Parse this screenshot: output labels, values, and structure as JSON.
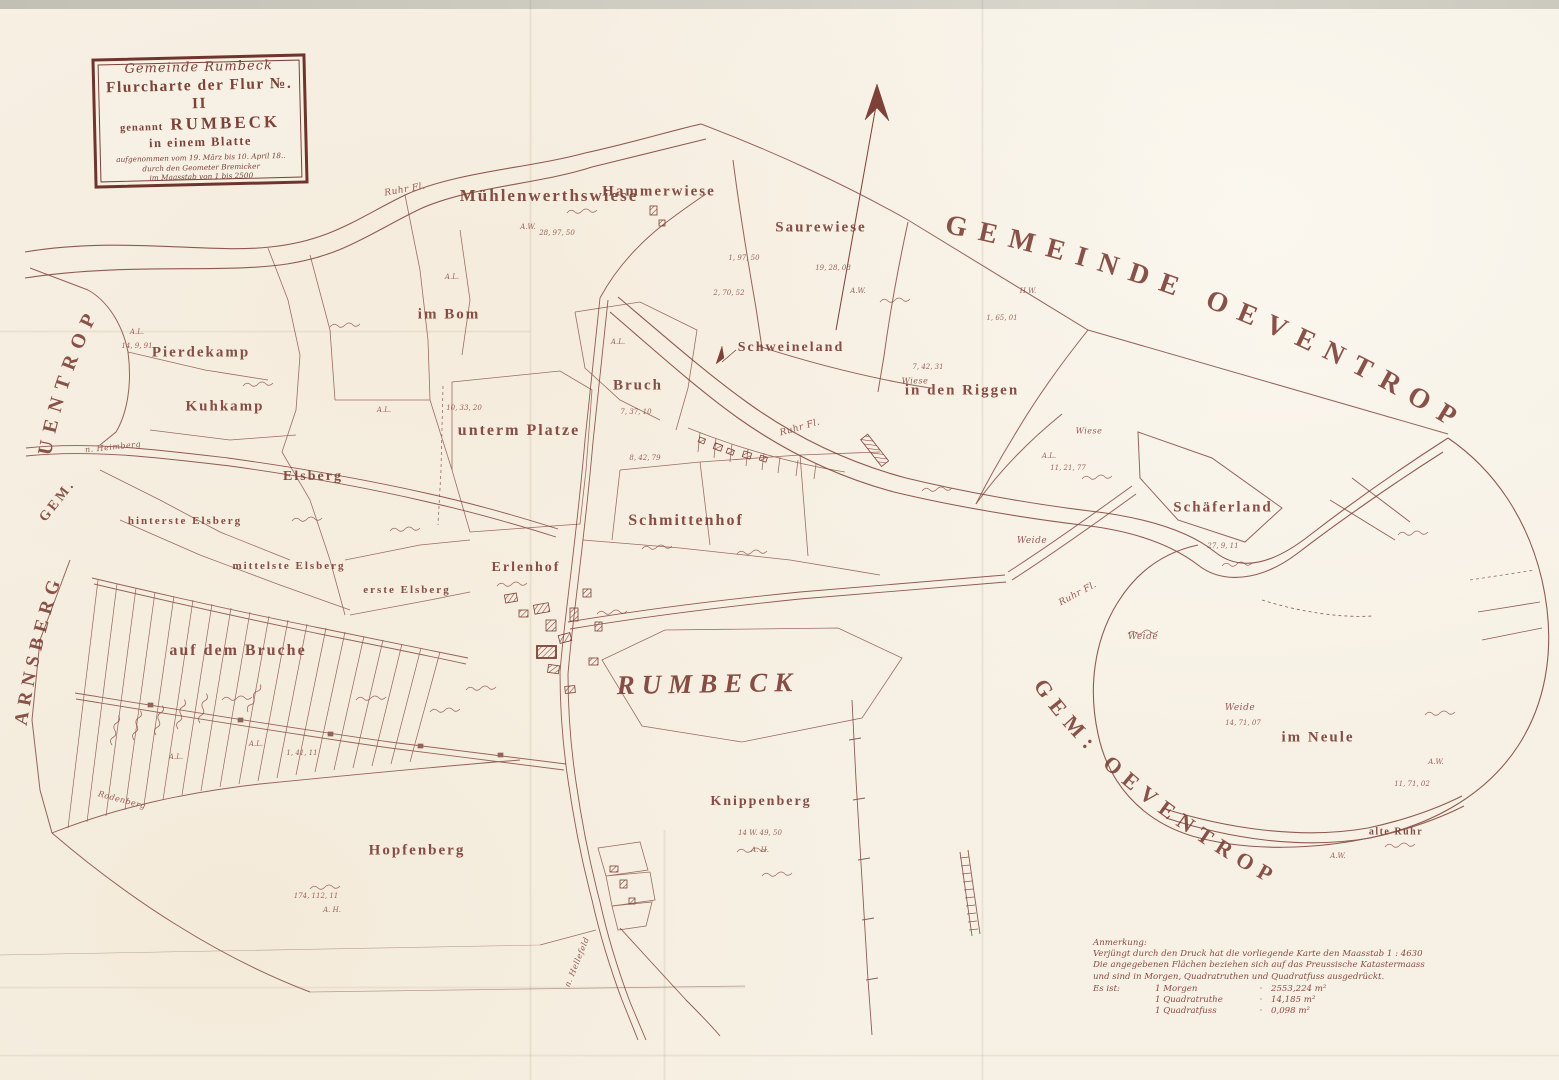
{
  "palette": {
    "paper": "#f6f0e4",
    "ink": "#7d4138",
    "ink_soft": "#8a4a40",
    "scan_edge": "#c9c7bc"
  },
  "cartouche": {
    "community": "Gemeinde Rumbeck",
    "title": "Flurcharte der Flur №. II",
    "called": "genannt",
    "name": "RUMBECK",
    "sheet": "in einem Blatte",
    "fine1": "aufgenommen vom 19. März bis 10. April 18..",
    "fine2": "durch den Geometer Bremicker",
    "fine3": "im Maasstab von 1 bis 2500"
  },
  "boundary_labels": {
    "gemeinde_oeventrop": "GEMEINDE OEVENTROP",
    "gem_oeventrop": "GEM: OEVENTROP",
    "uentrop": "UENTROP",
    "gem": "GEM.",
    "arnsberg": "ARNSBERG"
  },
  "place_labels": {
    "muehlenwerthswiese": "Mühlenwerthswiese",
    "hammerwiese": "Hammerwiese",
    "saurewiese": "Saurewiese",
    "im_bom": "im Bom",
    "pierdekamp": "Pierdekamp",
    "kuhkamp": "Kuhkamp",
    "schweineland": "Schweineland",
    "in_den_riggen": "in den Riggen",
    "bruch": "Bruch",
    "unterm_platze": "unterm Platze",
    "elsberg": "Elsberg",
    "hinterste_elsberg": "hinterste Elsberg",
    "mittelste_elsberg": "mittelste Elsberg",
    "erste_elsberg": "erste Elsberg",
    "schmittenhof": "Schmittenhof",
    "erlenhof": "Erlenhof",
    "schaeferland": "Schäferland",
    "auf_dem_bruche": "auf dem Bruche",
    "rumbeck": "RUMBECK",
    "knippenberg": "Knippenberg",
    "hopfenberg": "Hopfenberg",
    "im_neule": "im Neule",
    "alte_ruhr": "alte Ruhr"
  },
  "script_labels": {
    "ruhr_fl": "Ruhr Fl.",
    "n_heimberg": "n. Heimberg",
    "rodenberg": "Rodenberg",
    "n_hellefeld": "n. Hellefeld",
    "weide": "Weide",
    "wiese": "Wiese"
  },
  "parcel_annotations": [
    "A.L.",
    "14, 9, 91",
    "A.L.",
    "10, 33, 20",
    "A.L.",
    "A.W.",
    "28, 97, 50",
    "1, 97, 50",
    "19, 28, 08",
    "A.W.",
    "7, 42, 31",
    "2, 70, 52",
    "H.W.",
    "1, 65, 01",
    "A.L.",
    "11, 21, 77",
    "A.L.",
    "A.L.",
    "1, 41, 11",
    "14 W. 49, 50",
    "A. H.",
    "174, 112, 11",
    "A. H.",
    "14, 71, 07",
    "A.W.",
    "11, 71, 02",
    "A.W.",
    "27, 9, 11",
    "8, 42, 79",
    "7, 37, 10",
    "A.L."
  ],
  "annotation_block": {
    "title": "Anmerkung:",
    "line1": "Verjüngt durch den Druck hat die vorliegende Karte den Maasstab 1 : 4630",
    "line2": "Die angegebenen Flächen beziehen sich auf das Preussische Katastermaass",
    "line3": "und sind in Morgen, Quadratruthen und Quadratfuss ausgedrückt.",
    "intro": "Es ist:",
    "conversions": [
      {
        "term": "1 Morgen",
        "sep": "·",
        "value": "2553,224 m²"
      },
      {
        "term": "1 Quadratruthe",
        "sep": "·",
        "value": "14,185 m²"
      },
      {
        "term": "1 Quadratfuss",
        "sep": "·",
        "value": "0,098 m²"
      }
    ]
  }
}
